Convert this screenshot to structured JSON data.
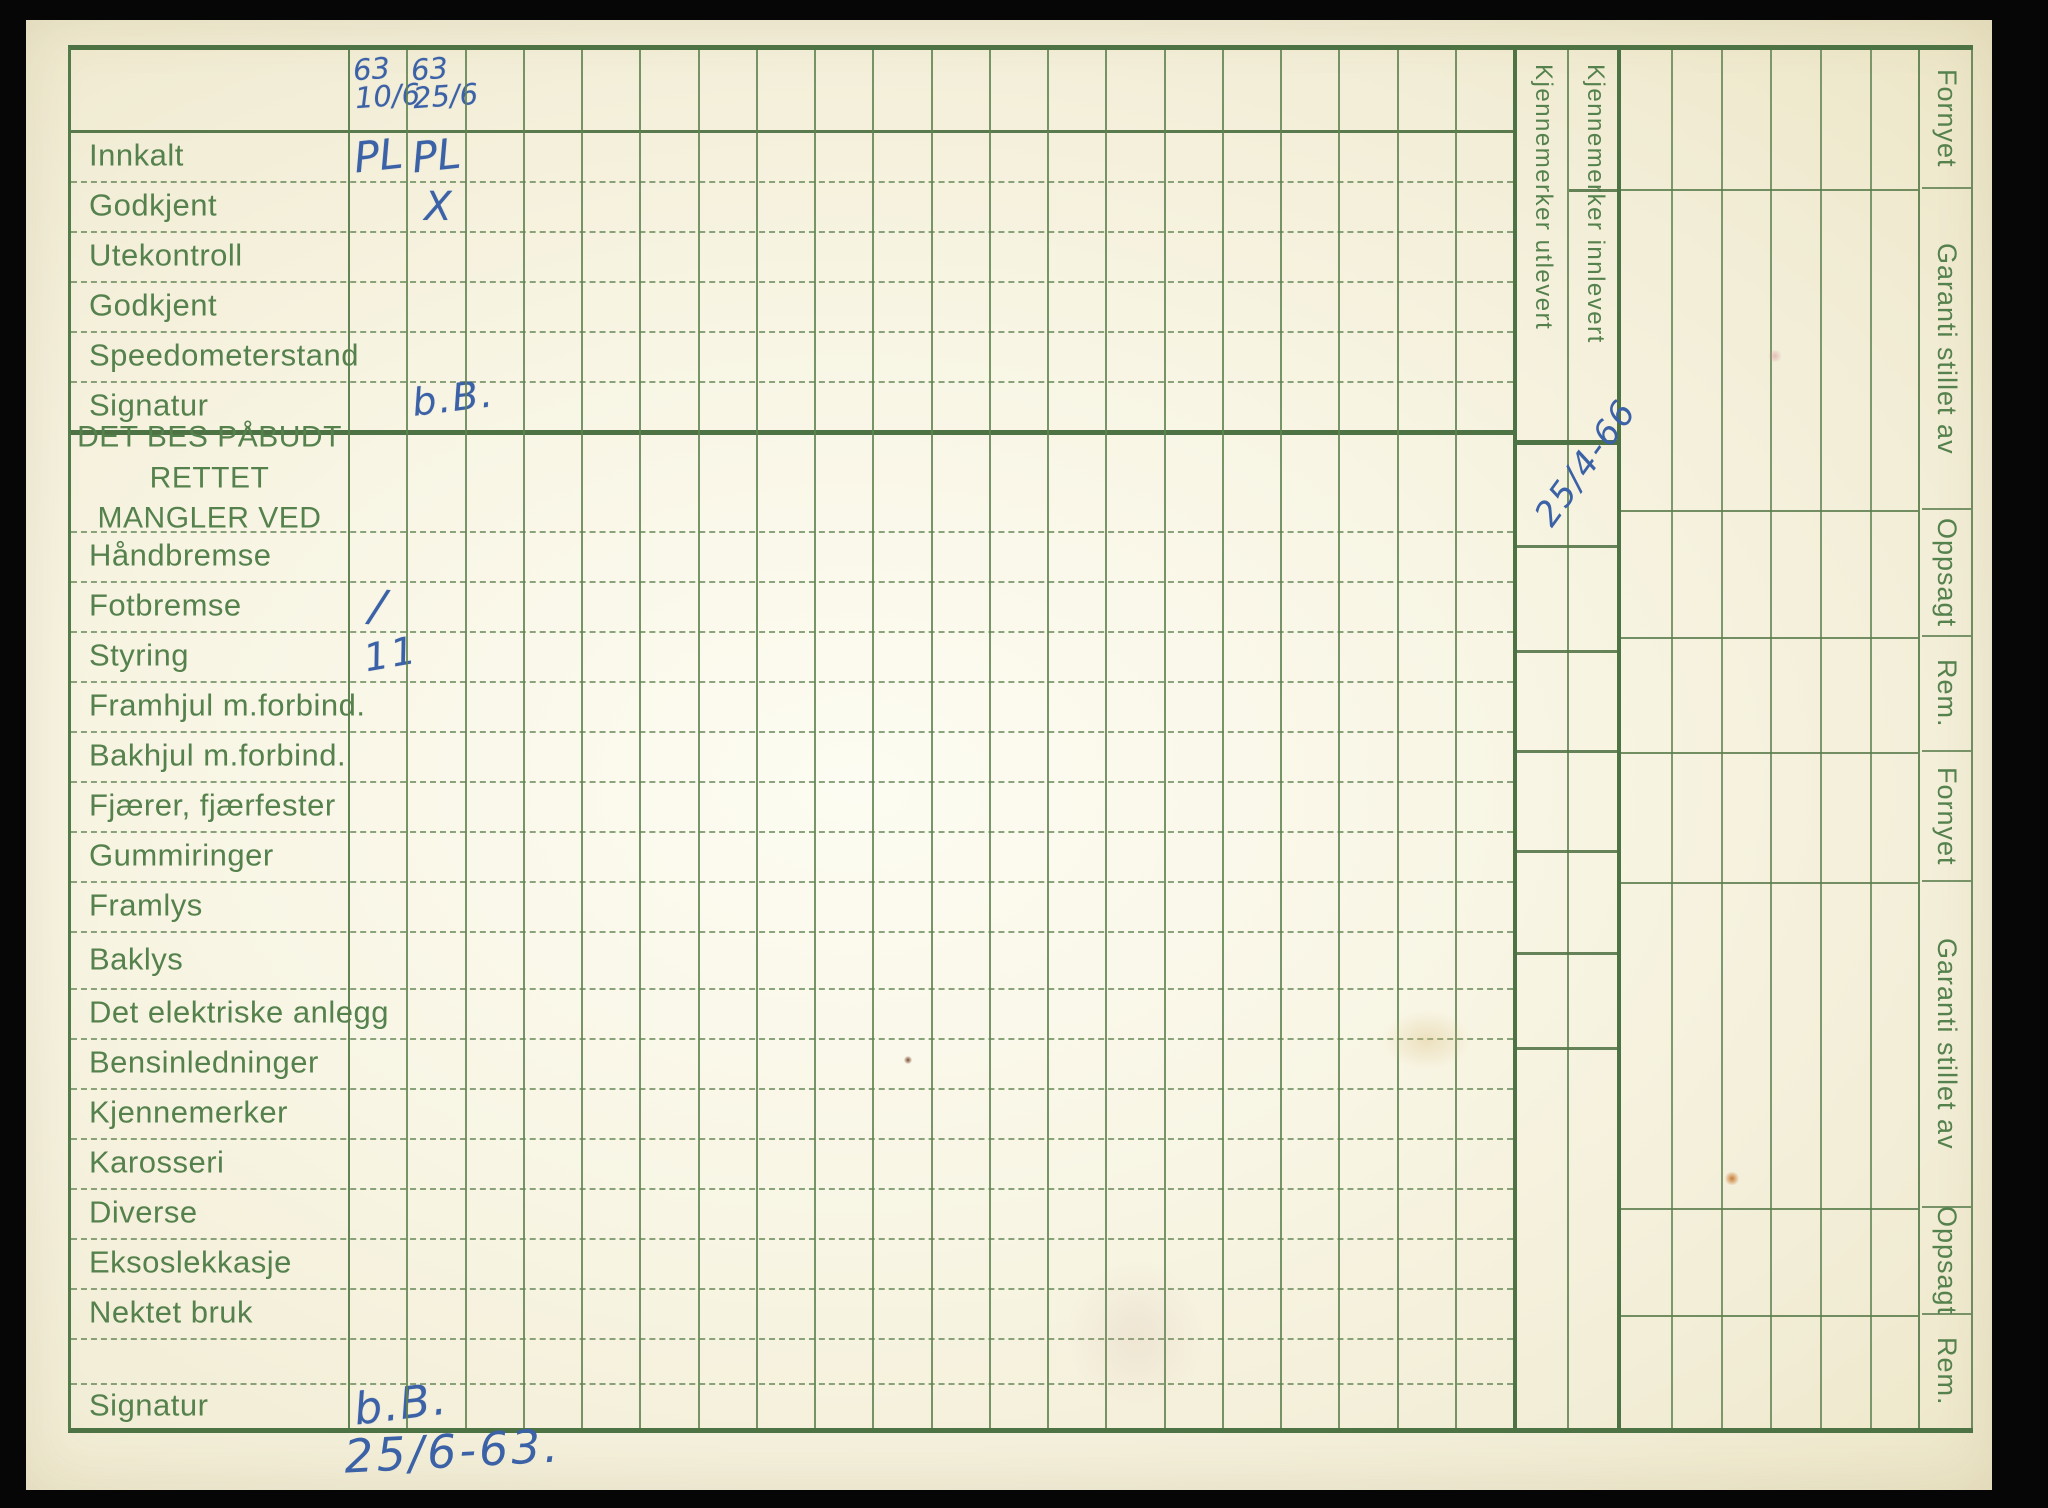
{
  "card": {
    "rows": [
      {
        "label": "",
        "h": 83,
        "variant": "header",
        "hand": [
          {
            "col": 1,
            "text": "63\n10/6",
            "style": "stack"
          },
          {
            "col": 2,
            "text": "63\n25/6",
            "style": "stack"
          }
        ]
      },
      {
        "label": "Innkalt",
        "h": 50,
        "hand": [
          {
            "col": 1,
            "text": "PL",
            "style": "pl"
          },
          {
            "col": 2,
            "text": "PL",
            "style": "pl"
          }
        ]
      },
      {
        "label": "Godkjent",
        "h": 50,
        "hand": [
          {
            "col": 2,
            "text": "X",
            "style": "x"
          }
        ]
      },
      {
        "label": "Utekontroll",
        "h": 50
      },
      {
        "label": "Godkjent",
        "h": 50
      },
      {
        "label": "Speedometerstand",
        "h": 50
      },
      {
        "label": "Signatur",
        "h": 52,
        "variant": "thick",
        "hand": [
          {
            "col": 2,
            "text": "b.B.",
            "style": "script"
          }
        ]
      },
      {
        "label": "DET BES PÅBUDT RETTET\nMANGLER VED",
        "h": 98,
        "variant": "title"
      },
      {
        "label": "Håndbremse",
        "h": 50
      },
      {
        "label": "Fotbremse",
        "h": 50,
        "hand": [
          {
            "col": 1,
            "text": "/",
            "style": "slash"
          }
        ]
      },
      {
        "label": "Styring",
        "h": 50,
        "hand": [
          {
            "col": 1,
            "text": "11",
            "style": "ii"
          }
        ]
      },
      {
        "label": "Framhjul m.forbind.",
        "h": 50
      },
      {
        "label": "Bakhjul m.forbind.",
        "h": 50
      },
      {
        "label": "Fjærer, fjærfester",
        "h": 50
      },
      {
        "label": "Gummiringer",
        "h": 50
      },
      {
        "label": "Framlys",
        "h": 50
      },
      {
        "label": "Baklys",
        "h": 57
      },
      {
        "label": "Det elektriske anlegg",
        "h": 50
      },
      {
        "label": "Bensinledninger",
        "h": 50
      },
      {
        "label": "Kjennemerker",
        "h": 50
      },
      {
        "label": "Karosseri",
        "h": 50
      },
      {
        "label": "Diverse",
        "h": 50
      },
      {
        "label": "Eksoslekkasje",
        "h": 50
      },
      {
        "label": "Nektet bruk",
        "h": 50
      },
      {
        "label": "",
        "h": 45
      },
      {
        "label": "Signatur",
        "h": 43,
        "variant": "last",
        "hand": [
          {
            "col": 1,
            "text": "b.B.",
            "style": "script big"
          }
        ]
      }
    ],
    "grid_columns": 20,
    "kjennemerker_columns": [
      {
        "label": "Kjennemerker utlevert"
      },
      {
        "label": "Kjennemerker innlevert",
        "handwritten_date": "25/4-66"
      }
    ],
    "right_labels": [
      {
        "label": "Fornyet",
        "h": 139
      },
      {
        "label": "Garanti stillet av",
        "h": 321
      },
      {
        "label": "Oppsagt",
        "h": 127
      },
      {
        "label": "Rem.",
        "h": 115
      },
      {
        "label": "Fornyet",
        "h": 130
      },
      {
        "label": "Garanti stillet av",
        "h": 326
      },
      {
        "label": "Oppsagt",
        "h": 107
      },
      {
        "label": "Rem.",
        "h": 113
      }
    ],
    "annotations": {
      "bottom_date": "25/6-63."
    },
    "colors": {
      "background": "#060606",
      "paper": "#f5f1dd",
      "grid_green": "#5f8454",
      "thick_green": "#4d7243",
      "label_green": "#55814d",
      "ink_blue": "#3b61a6"
    }
  }
}
